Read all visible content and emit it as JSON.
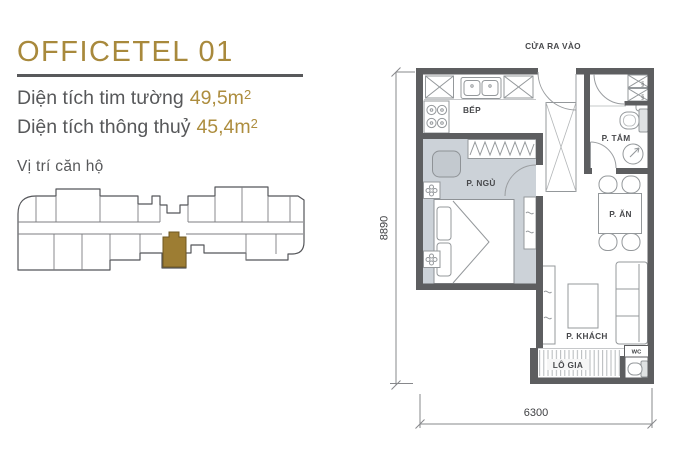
{
  "panel": {
    "title": "OFFICETEL 01",
    "area1": {
      "label": "Diện tích tim tường",
      "value": "49,5m",
      "sup": "2"
    },
    "area2": {
      "label": "Diện tích thông thuỷ",
      "value": "45,4m",
      "sup": "2"
    },
    "location_label": "Vị trí căn hộ"
  },
  "floorplan": {
    "entrance_label": "CỬA RA VÀO",
    "rooms": {
      "kitchen": "BẾP",
      "bedroom": "P. NGỦ",
      "bathroom": "P. TẮM",
      "dining": "P. ĂN",
      "living": "P. KHÁCH",
      "loggia": "LÔ GIA",
      "wc": "WC"
    },
    "appliances": {
      "washer_top": "MW",
      "washer_bottom": "MW"
    },
    "dimensions": {
      "width": "6300",
      "height": "8890"
    }
  },
  "colors": {
    "accent_gold": "#A8893C",
    "unit_highlight": "#9D7D33",
    "text_gray": "#58595B",
    "wall_gray": "#5D5E60",
    "bedroom_floor": "#CCD2D8"
  }
}
